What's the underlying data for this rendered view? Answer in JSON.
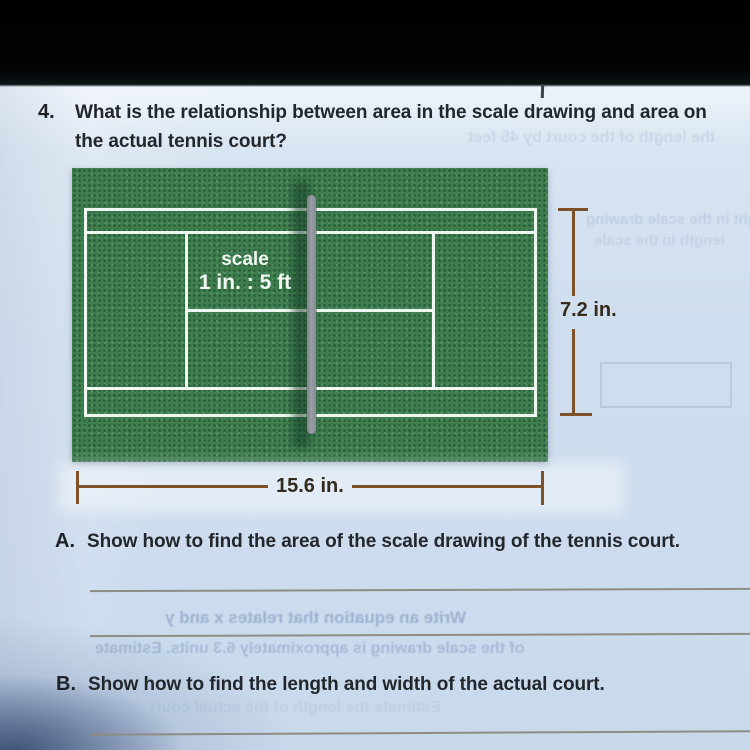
{
  "question": {
    "number": "4.",
    "lines": [
      "What is the relationship between area in the scale drawing and area on",
      "the actual tennis court?"
    ]
  },
  "diagram": {
    "scale_label_line1": "scale",
    "scale_label_line2": "1 in. : 5 ft",
    "height_label": "7.2 in.",
    "width_label": "15.6 in."
  },
  "parts": {
    "a_label": "A.",
    "a_text": "Show how to find the area of the scale drawing of the tennis court.",
    "b_label": "B.",
    "b_text": "Show how to find the length and width of the actual court."
  },
  "bleedthrough": {
    "line1": "Write an equation that relates x and y",
    "line2": "of the scale drawing is approximately 6.3 units. Estimate",
    "line3": "the length of the court by 45 feet",
    "line4": "at right in the scale drawing",
    "line5": "length in the scale",
    "line6": "Estimate the length of the actual court"
  },
  "colors": {
    "court_green": "#3d7d4e",
    "court_line_white": "#edf6ef",
    "net_gray": "#8f969e",
    "dimension_brown": "#7d5228",
    "paper_blue": "#cfdeee",
    "text_dark": "#23272c",
    "top_band_black": "#020404"
  }
}
